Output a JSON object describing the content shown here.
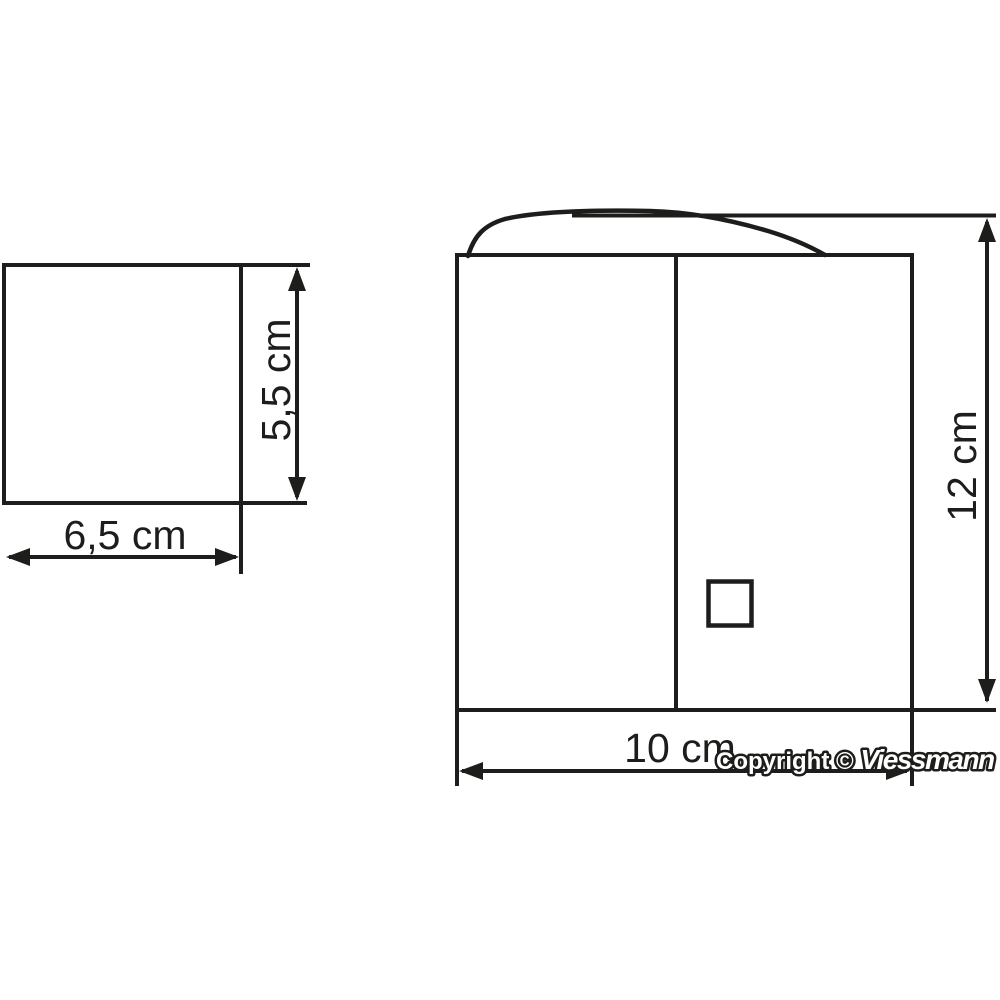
{
  "diagram": {
    "background_color": "#ffffff",
    "line_color": "#1d1d1b",
    "left_shape": {
      "width_label": "6,5 cm",
      "height_label": "5,5 cm"
    },
    "right_shape": {
      "width_label": "10 cm",
      "height_label": "12 cm"
    },
    "copyright": {
      "prefix": "Copyright © ",
      "brand": "Viessmann"
    }
  }
}
